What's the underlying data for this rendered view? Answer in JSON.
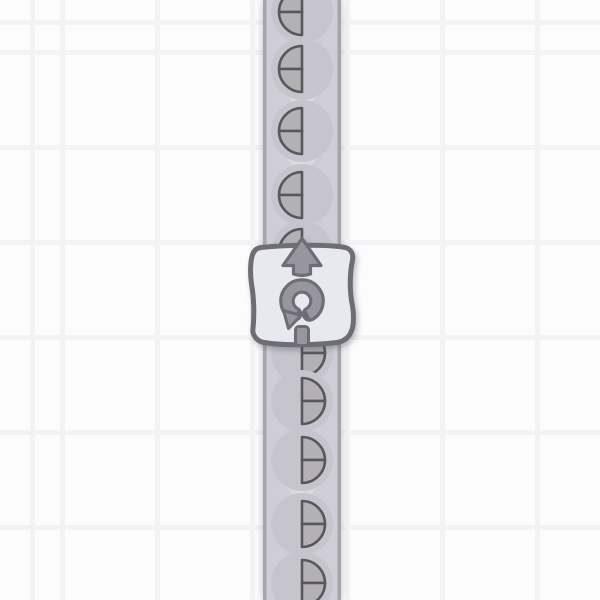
{
  "scene": {
    "app": "factory-game",
    "view": "vertical conveyor belt with a rotator building and half-circle shape items",
    "grid": {
      "cell_size": 95,
      "line_thickness": 5,
      "offset_x": 60,
      "offset_y": 50,
      "bg_color": "#fcfcfd",
      "line_color": "#f3f3f5"
    },
    "belt": {
      "direction": "up",
      "x": 263,
      "width": 78,
      "center_x": 302,
      "fill": "#cfced6",
      "edge_color": "#a6a5ad",
      "edge_width": 3.5,
      "chevron_color": "#dad9df",
      "chevron_ys": [
        40,
        100,
        163,
        223,
        339,
        377,
        430,
        492,
        553
      ]
    },
    "items": {
      "radius": 23,
      "bg_radius": 31,
      "bg_color": "#c6c5cd",
      "fill": "#b3b1b3",
      "outline_color": "#56585c",
      "outline_width": 2.6,
      "list": [
        {
          "y": 12,
          "half": "left"
        },
        {
          "y": 69,
          "half": "left"
        },
        {
          "y": 131,
          "half": "left"
        },
        {
          "y": 195,
          "half": "left"
        },
        {
          "y": 252,
          "half": "left"
        },
        {
          "y": 353,
          "half": "right"
        },
        {
          "y": 401,
          "half": "right"
        },
        {
          "y": 460,
          "half": "right"
        },
        {
          "y": 524,
          "half": "right"
        },
        {
          "y": 583,
          "half": "right"
        }
      ]
    },
    "building": {
      "type": "rotator",
      "rotation_direction": "counter-clockwise",
      "output_direction": "up",
      "card_fill": "#e8e8ef",
      "outline_color": "#6d6d75",
      "icon_fill": "#97969e"
    }
  }
}
